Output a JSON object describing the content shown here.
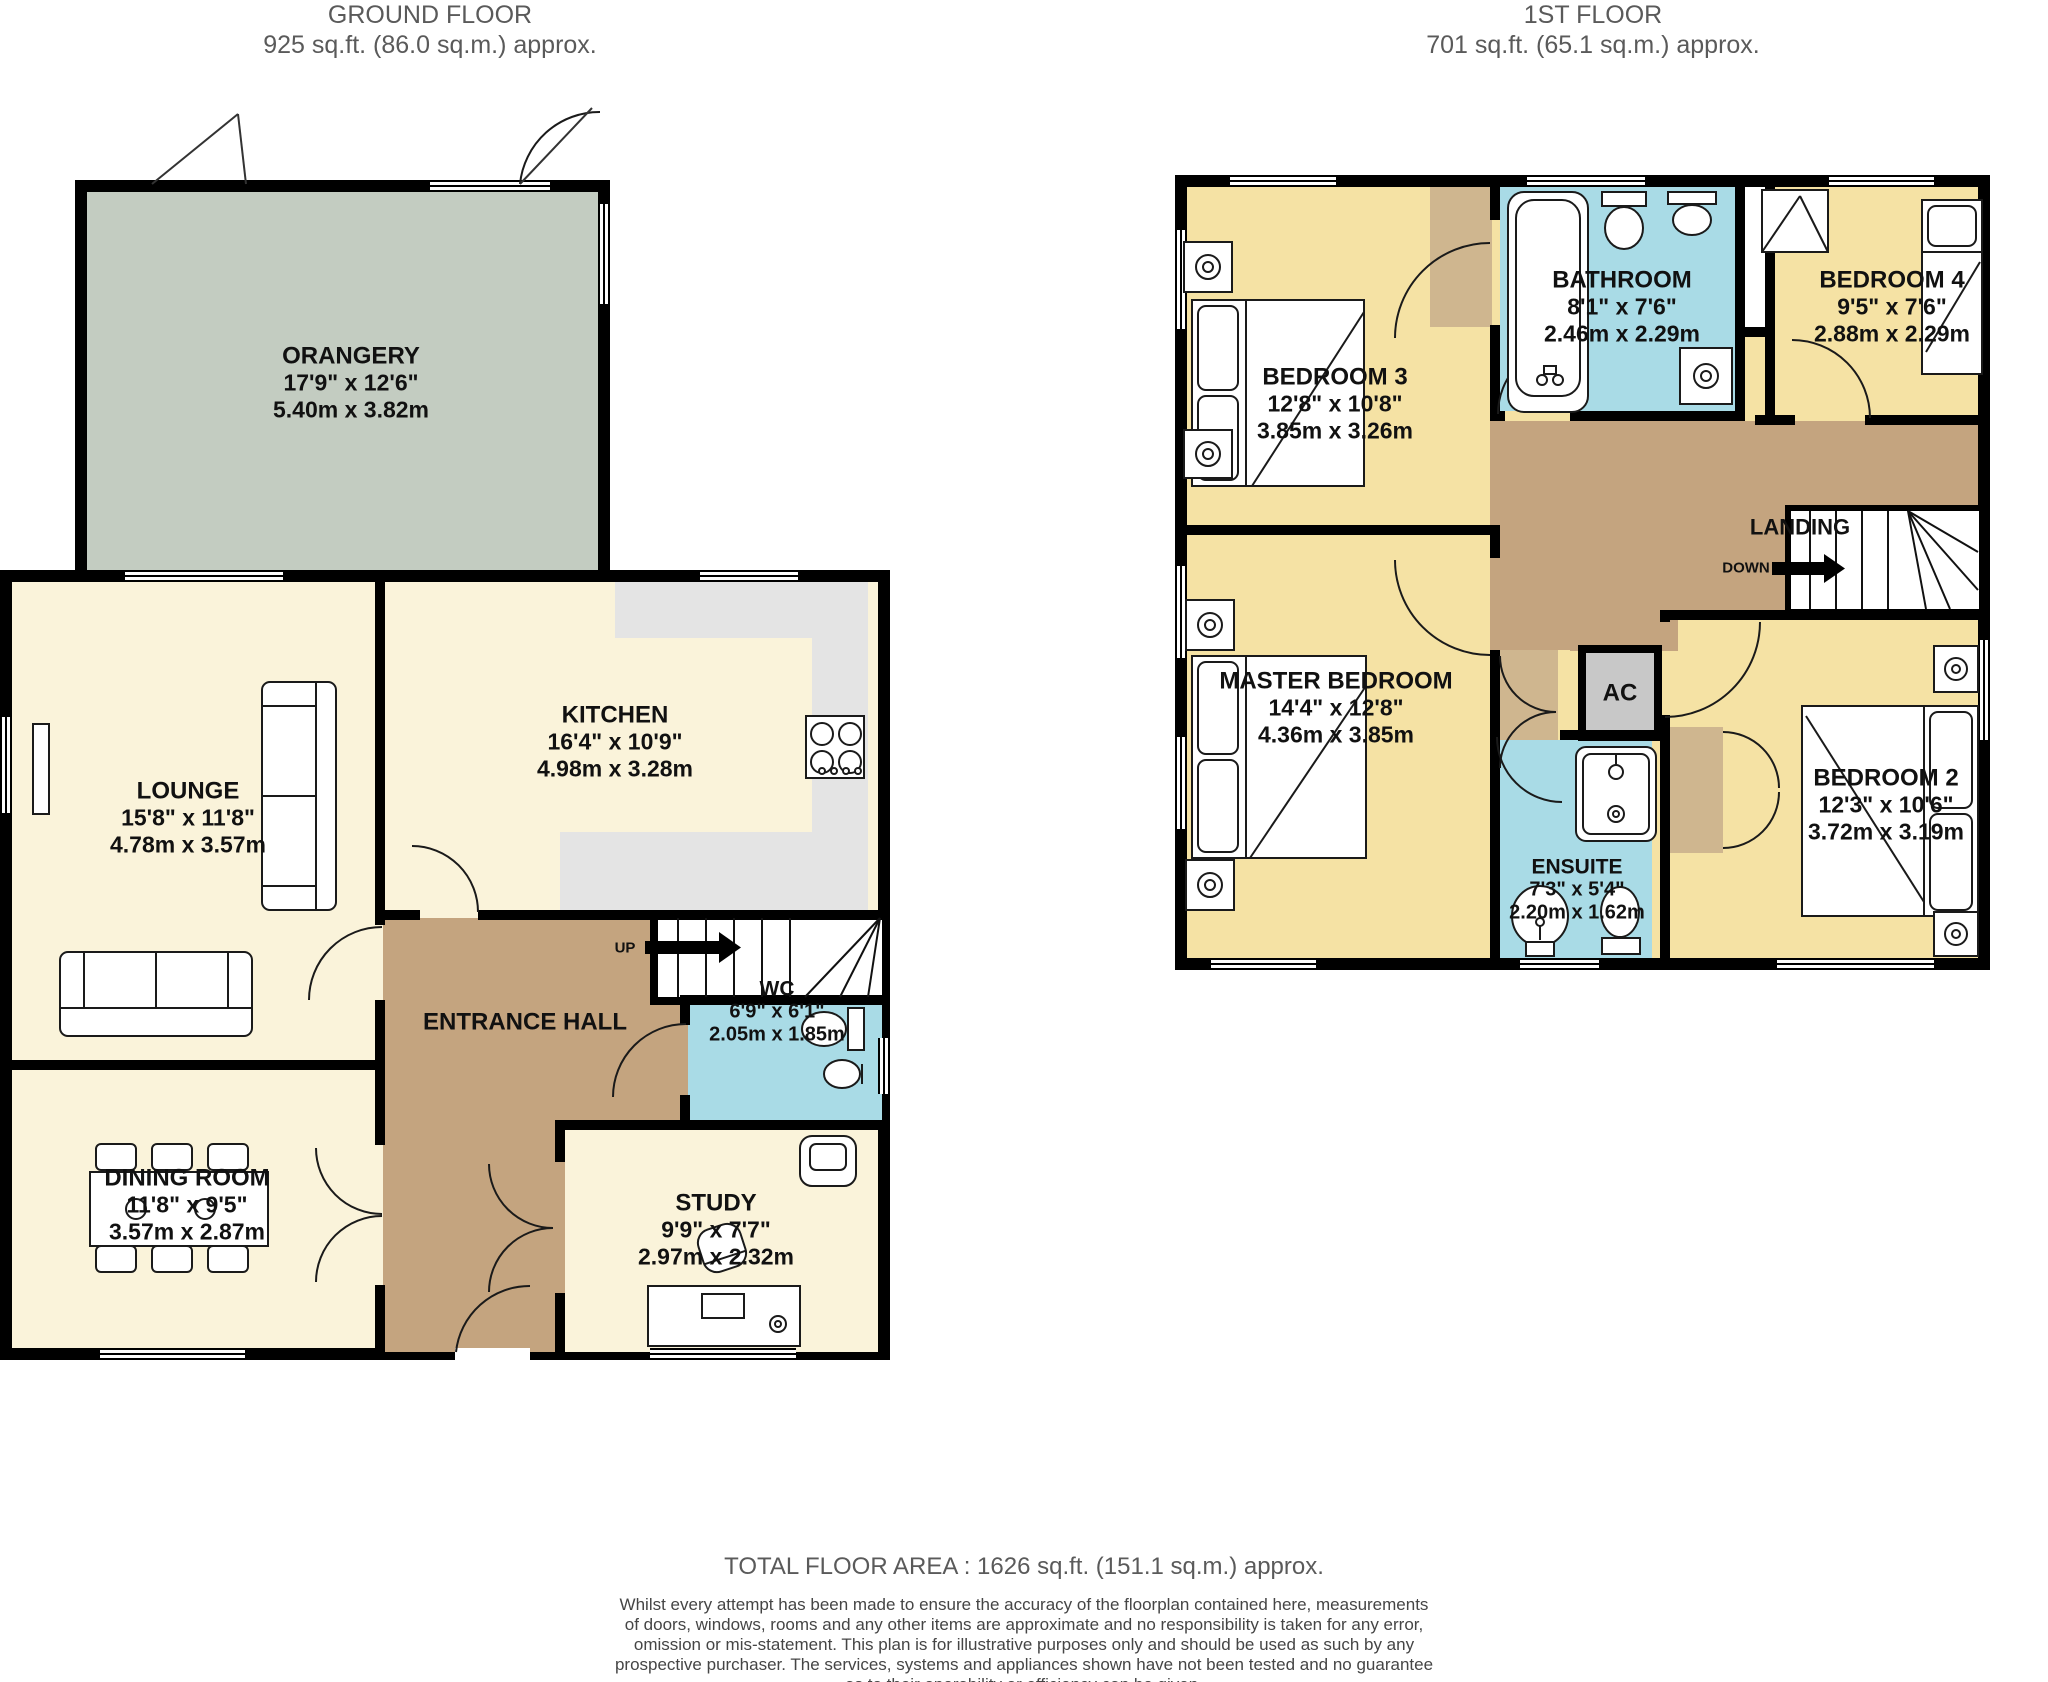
{
  "colors": {
    "wall": "#000000",
    "room_cream": "#faf3da",
    "room_yellow": "#f5e2a4",
    "hall_tan": "#c4a47f",
    "closet_tan": "#cfb68f",
    "orangery_green": "#c3ccc1",
    "wet_room_blue": "#a9dbe6",
    "ac_gray": "#c8c8c8",
    "counter_gray": "#e4e4e4",
    "header_text": "#5a5a5a"
  },
  "ground_floor": {
    "title": "GROUND FLOOR",
    "subtitle": "925 sq.ft. (86.0 sq.m.) approx.",
    "up_label": "UP",
    "rooms": {
      "orangery": {
        "name": "ORANGERY",
        "imperial": "17'9\"  x 12'6\"",
        "metric": "5.40m  x 3.82m"
      },
      "lounge": {
        "name": "LOUNGE",
        "imperial": "15'8\"  x 11'8\"",
        "metric": "4.78m  x 3.57m"
      },
      "kitchen": {
        "name": "KITCHEN",
        "imperial": "16'4\"  x 10'9\"",
        "metric": "4.98m  x 3.28m"
      },
      "entrance_hall": {
        "name": "ENTRANCE HALL"
      },
      "wc": {
        "name": "WC",
        "imperial": "6'9\"  x 6'1\"",
        "metric": "2.05m  x 1.85m"
      },
      "dining_room": {
        "name": "DINING ROOM",
        "imperial": "11'8\"  x 9'5\"",
        "metric": "3.57m  x 2.87m"
      },
      "study": {
        "name": "STUDY",
        "imperial": "9'9\"  x 7'7\"",
        "metric": "2.97m  x 2.32m"
      }
    }
  },
  "first_floor": {
    "title": "1ST FLOOR",
    "subtitle": "701 sq.ft. (65.1 sq.m.) approx.",
    "down_label": "DOWN",
    "rooms": {
      "bedroom3": {
        "name": "BEDROOM 3",
        "imperial": "12'8\"  x 10'8\"",
        "metric": "3.85m  x 3.26m"
      },
      "bathroom": {
        "name": "BATHROOM",
        "imperial": "8'1\"  x 7'6\"",
        "metric": "2.46m  x 2.29m"
      },
      "bedroom4": {
        "name": "BEDROOM 4",
        "imperial": "9'5\"  x 7'6\"",
        "metric": "2.88m  x 2.29m"
      },
      "landing": {
        "name": "LANDING"
      },
      "master_bedroom": {
        "name": "MASTER BEDROOM",
        "imperial": "14'4\"  x 12'8\"",
        "metric": "4.36m  x 3.85m"
      },
      "ac": {
        "name": "AC"
      },
      "ensuite": {
        "name": "ENSUITE",
        "imperial": "7'3\"  x 5'4\"",
        "metric": "2.20m  x 1.62m"
      },
      "bedroom2": {
        "name": "BEDROOM 2",
        "imperial": "12'3\"  x 10'6\"",
        "metric": "3.72m  x 3.19m"
      }
    }
  },
  "footer": {
    "total": "TOTAL FLOOR AREA : 1626 sq.ft. (151.1 sq.m.) approx.",
    "disclaimer": "Whilst every attempt has been made to ensure the accuracy of the floorplan contained here, measurements of doors, windows, rooms and any other items are approximate and no responsibility is taken for any error, omission or mis-statement. This plan is for illustrative purposes only and should be used as such by any prospective purchaser. The services, systems and appliances shown have not been tested and no guarantee as to their operability or efficiency can be given.",
    "credit": "Made with Metropix ©2023"
  }
}
